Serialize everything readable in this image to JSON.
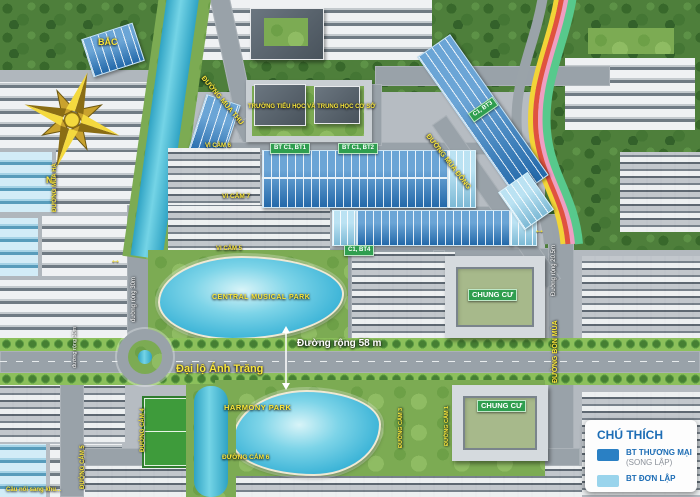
{
  "map": {
    "compass": {
      "north": "BẮC",
      "south": "N"
    },
    "roads": {
      "mua_thu": "ĐƯỜNG MÙA THU",
      "mua_dong": "ĐƯỜNG MÙA ĐÔNG",
      "mua_ha": "ĐƯỜNG MÙA HẠ",
      "bon_mua": "ĐƯỜNG BỐN MÙA",
      "cam1": "ĐƯỜNG CẢM 1",
      "cam3": "ĐƯỜNG CẢM 3",
      "cam4": "ĐƯỜNG CẢM 4",
      "cam5": "ĐƯỜNG CẢM 5",
      "cam6": "ĐƯỜNG CẢM 6",
      "boulevard_name": "Đại lộ Ánh Trăng",
      "width58": "Đường rộng 58 m",
      "width30": "đường rộng 30m",
      "width205": "Đường rộng 20.5m"
    },
    "areas": {
      "school": "TRƯỜNG TIỂU HỌC VÀ TRUNG HỌC CƠ SỞ",
      "vi_cam_5": "VI CẢM 5",
      "vi_cam_6": "VI CẢM 6",
      "vi_cam_7": "VI CẢM 7",
      "central_park": "CENTRAL MUSICAL PARK",
      "harmony_park": "HARMONY PARK",
      "chung_cu": "CHUNG CƯ",
      "bridge_note": "Cầu nối sang khu..."
    },
    "blocks": {
      "bt_c1_bt1": "BT C1, BT1",
      "bt_c1_bt2": "BT C1, BT2",
      "c1_bt3": "C1, BT3",
      "c1_bt4": "C1, BT4"
    },
    "legend": {
      "title": "CHÚ THÍCH",
      "items": [
        {
          "label": "BT THƯƠNG MẠI",
          "sublabel": "(SONG LẬP)",
          "color": "#2a80c4"
        },
        {
          "label": "BT ĐƠN LẬP",
          "sublabel": "",
          "color": "#99d4ec"
        }
      ]
    }
  }
}
